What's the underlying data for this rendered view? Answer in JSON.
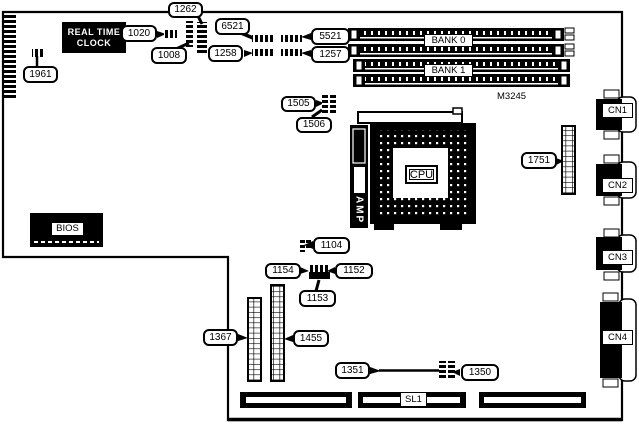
{
  "title": "Motherboard component location diagram",
  "colors": {
    "ink": "#000000",
    "paper": "#ffffff"
  },
  "board": {
    "model_id": "M3245",
    "rtc_line1": "REAL TIME",
    "rtc_line2": "CLOCK",
    "bios": "BIOS",
    "cpu": "CPU",
    "amp": "AMP",
    "bank0": "BANK 0",
    "bank1": "BANK 1",
    "sl1": "SL1",
    "cn1": "CN1",
    "cn2": "CN2",
    "cn3": "CN3",
    "cn4": "CN4",
    "callouts": {
      "1961": "1961",
      "1020": "1020",
      "1008": "1008",
      "1262": "1262",
      "6521": "6521",
      "5521": "5521",
      "1257": "1257",
      "1258": "1258",
      "1505": "1505",
      "1506": "1506",
      "1751": "1751",
      "1104": "1104",
      "1154": "1154",
      "1152": "1152",
      "1153": "1153",
      "1367": "1367",
      "1455": "1455",
      "1351": "1351",
      "1350": "1350"
    }
  }
}
